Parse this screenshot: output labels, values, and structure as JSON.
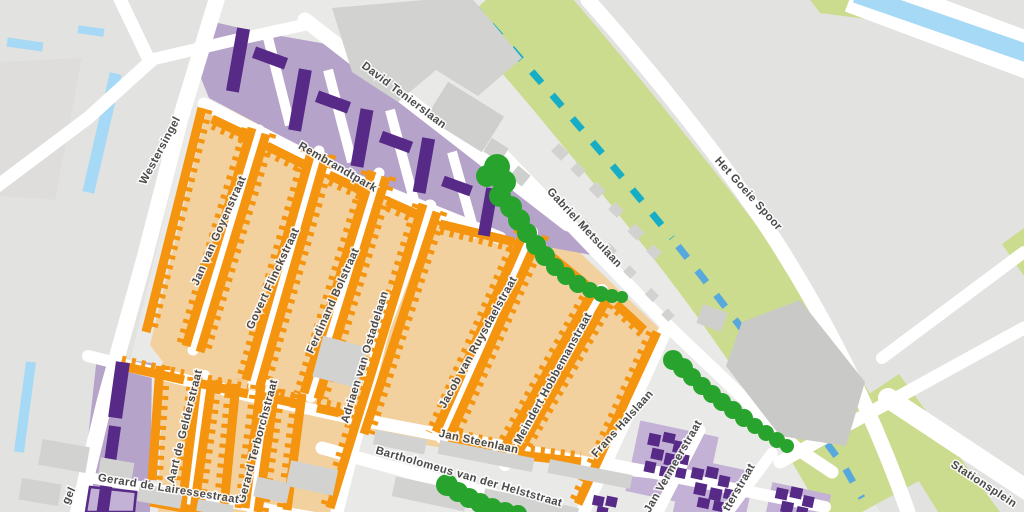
{
  "map": {
    "type": "street-map-detail",
    "area_description": "Painters district with residential blocks, rail corridor and station area"
  },
  "colors": {
    "background": "#e9e9e7",
    "side_area_gray": "#e2e2e0",
    "road": "#ffffff",
    "residential_orange": "#f5940f",
    "residential_orange_bg": "#f3d19e",
    "residential_purple": "#562a86",
    "residential_purple_bg": "#b5a3c9",
    "rail_corridor_green": "#ccdc8e",
    "rail_dash_teal": "#16aec6",
    "rail_dash_blue": "#57a9dd",
    "water_blue": "#a5d9f6",
    "tree_green": "#28a42e",
    "building_gray": "#d2d2d0",
    "label_text": "#4a4a4a"
  },
  "streets": [
    {
      "id": "westersingel",
      "label": "Westersingel"
    },
    {
      "id": "david-tenierslaan",
      "label": "David Tenierslaan"
    },
    {
      "id": "rembrandtpark",
      "label": "Rembrandtpark"
    },
    {
      "id": "het-goeie-spoor",
      "label": "Het Goeie Spoor"
    },
    {
      "id": "gabriel-metsulaan",
      "label": "Gabriel Metsulaan"
    },
    {
      "id": "jan-van-goyenstraat",
      "label": "Jan van Goyenstraat"
    },
    {
      "id": "govert-flinckstraat",
      "label": "Govert Flinckstraat"
    },
    {
      "id": "ferdinand-bolstraat",
      "label": "Ferdinand Bolstraat"
    },
    {
      "id": "adriaen-van-ostadelaan",
      "label": "Adriaen van Ostadelaan"
    },
    {
      "id": "jacob-van-ruysdaelstraat",
      "label": "Jacob van Ruysdaelstraat"
    },
    {
      "id": "meindert-hobbemanstraat",
      "label": "Meindert Hobbemanstraat"
    },
    {
      "id": "frans-halslaan",
      "label": "Frans Halslaan"
    },
    {
      "id": "aart-de-gelderstraat",
      "label": "Aart de Gelderstraat"
    },
    {
      "id": "gerard-terborchstraat",
      "label": "Gerard Terborchstraat"
    },
    {
      "id": "jan-steenlaan",
      "label": "Jan Steenlaan"
    },
    {
      "id": "bartholomeus-van-der-helststraat",
      "label": "Bartholomeus van der Helststraat"
    },
    {
      "id": "gerard-de-lairessestraat",
      "label": "Gerard de Lairessestraat"
    },
    {
      "id": "jan-vermeerstraat",
      "label": "Jan Vermeerstraat"
    },
    {
      "id": "potterstraat-fragment",
      "label": "tterstraat"
    },
    {
      "id": "stationsplein",
      "label": "Stationsplein"
    },
    {
      "id": "singel-fragment",
      "label": "gel"
    }
  ]
}
